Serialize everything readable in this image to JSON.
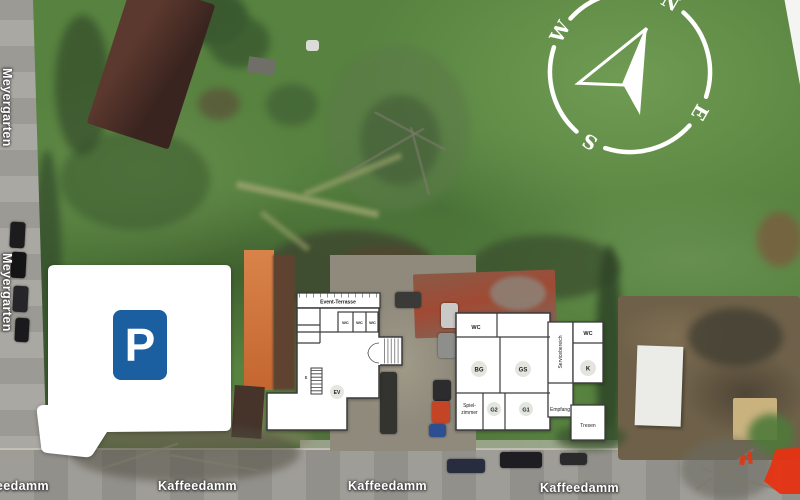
{
  "compass": {
    "n": "N",
    "e": "E",
    "s": "S",
    "w": "W"
  },
  "parking_sign": "P",
  "street_labels": {
    "kaffeedamm": [
      "Kaffeedamm",
      "Kaffeedamm",
      "Kaffeedamm",
      "Kaffeedamm"
    ],
    "meyergarten": [
      "Meyergarten",
      "Meyergarten"
    ]
  },
  "floorplan_left": {
    "terrace_label": "Event-Terrasse",
    "wc_labels": [
      "WC",
      "WC",
      "WC"
    ],
    "stair_label": "B",
    "elevator_label": "EV"
  },
  "floorplan_right": {
    "wc_top_left": "WC",
    "bg": "BG",
    "gs": "GS",
    "spielzimmer_line1": "Spiel-",
    "spielzimmer_line2": "zimmer",
    "g2": "G2",
    "g1": "G1",
    "empfang": "Empfang",
    "servicebereich": "Servicebereich",
    "wc_right": "WC",
    "k": "K",
    "tresen": "Tresen"
  },
  "colors": {
    "parking_blue": "#1b5fa0",
    "marker_red": "#e63312",
    "plan_wall": "#3c3c3c"
  }
}
